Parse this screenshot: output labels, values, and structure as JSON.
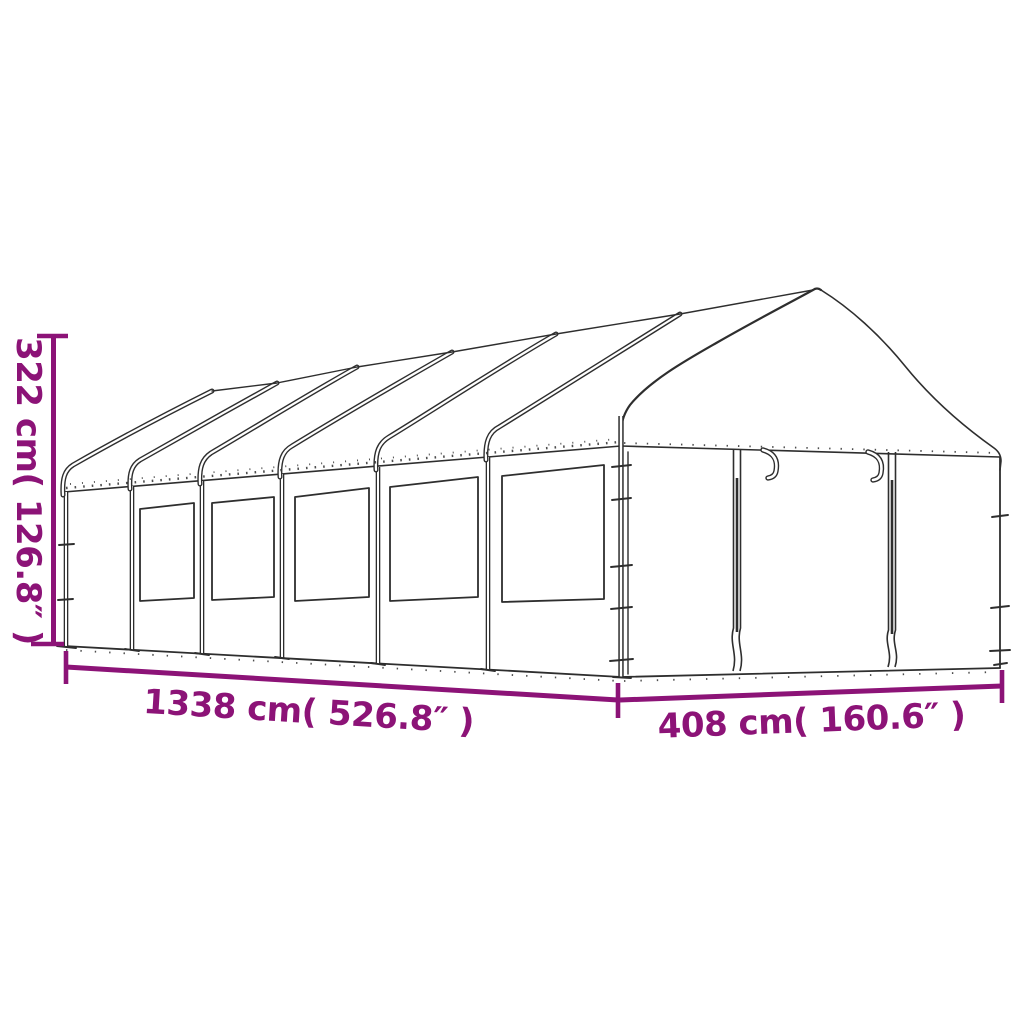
{
  "page": {
    "background": "#ffffff",
    "accent_color": "#8C1377",
    "drawing_line_color": "#2e2e2e"
  },
  "diagram": {
    "kind": "product-dimension-line-drawing",
    "subject": "long gazebo tent with windows and front door panels",
    "labels": {
      "height": "322 cm( 126.8″ )",
      "length": "1338 cm( 526.8″ )",
      "width": "408 cm( 160.6″ )"
    },
    "features": {
      "side_window_count": 6,
      "roof_peak_count": 6,
      "front_door_panel_count": 2
    }
  }
}
